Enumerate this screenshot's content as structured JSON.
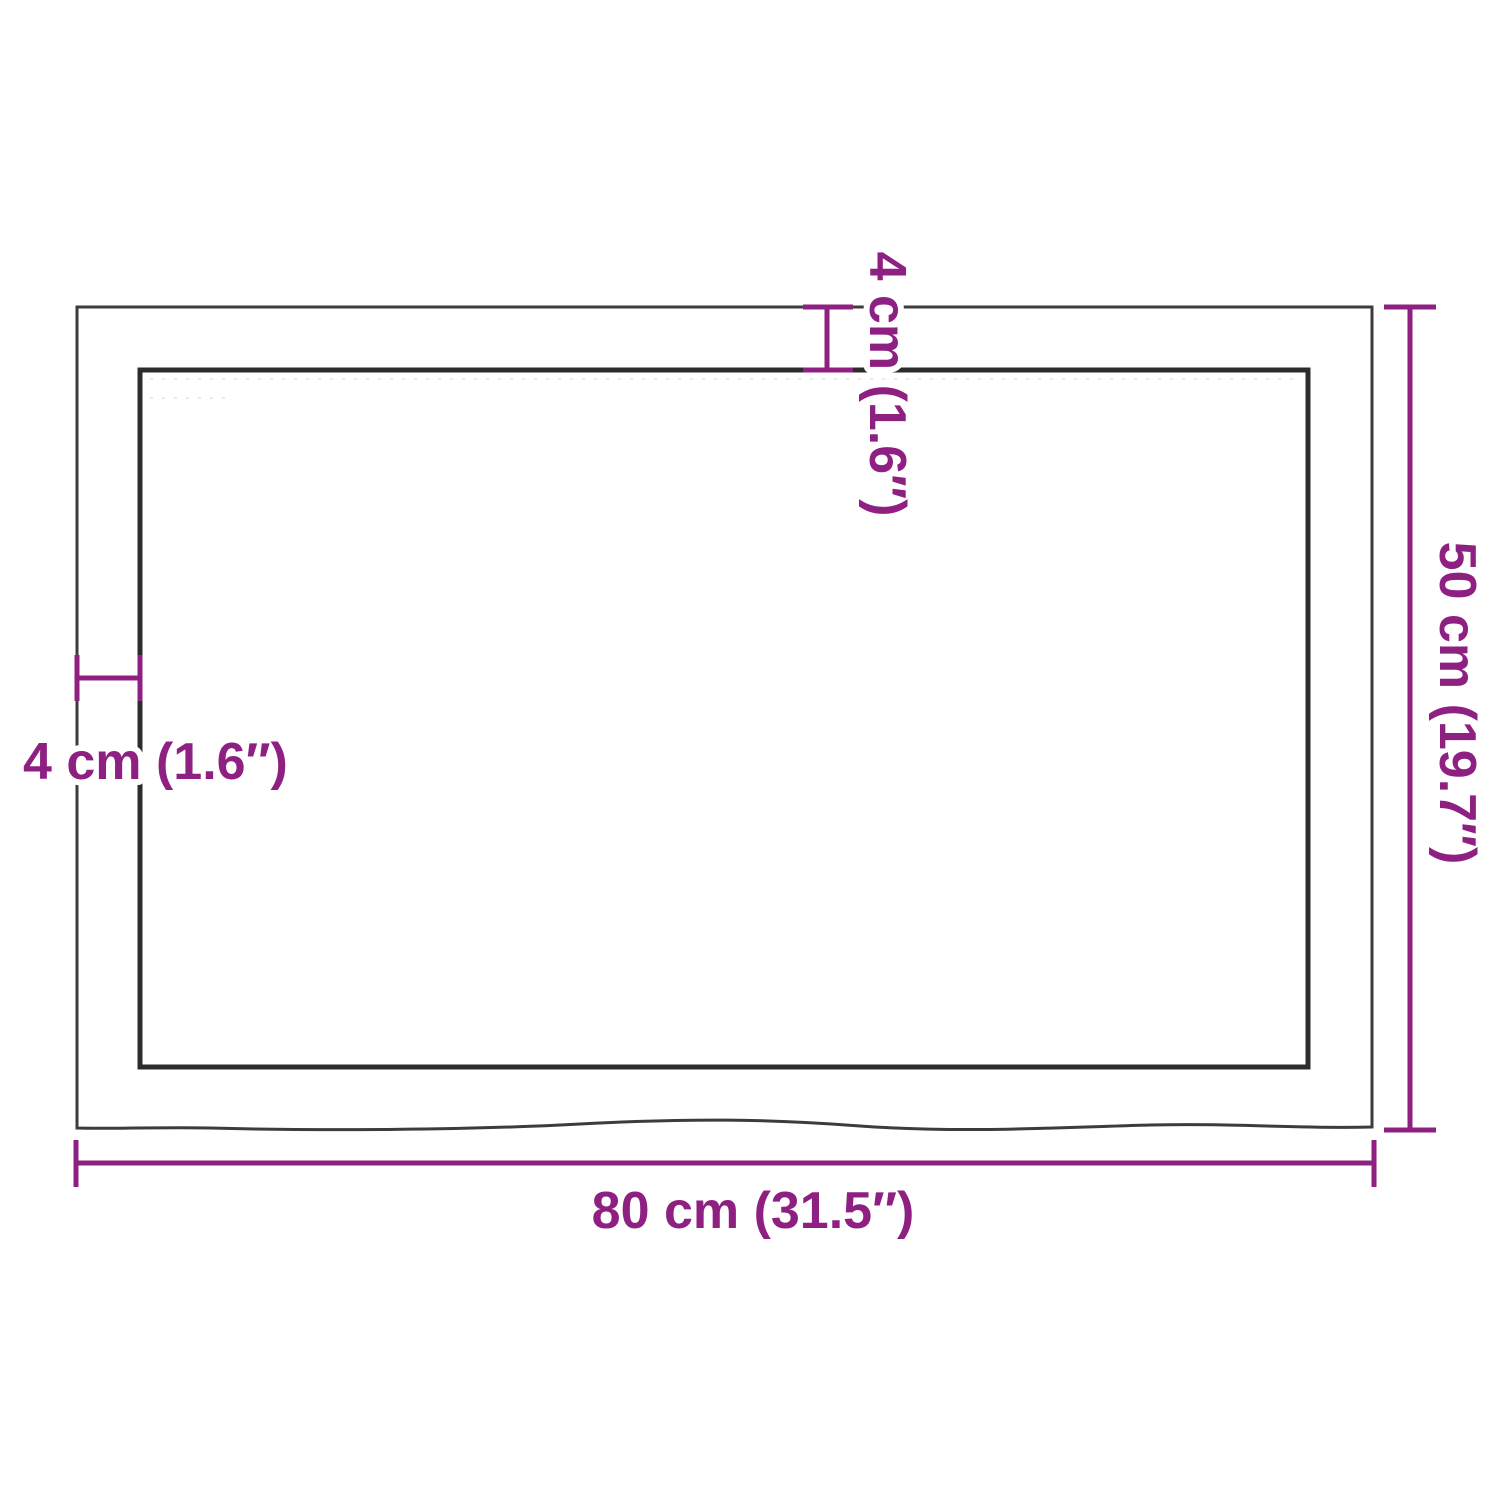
{
  "diagram": {
    "kind": "product-dimension-diagram",
    "labels": {
      "width": "80 cm (31.5″)",
      "height": "50 cm (19.7″)",
      "thickness_top": "4 cm (1.6″)",
      "thickness_left": "4 cm (1.6″)"
    }
  },
  "colors": {
    "dimension_accent": "#8E2082",
    "outer_outline": "#3C3C3C",
    "inner_outline": "#2C2C2C",
    "grain_speckle": "#9a9a9a",
    "background": "#FFFFFF"
  }
}
